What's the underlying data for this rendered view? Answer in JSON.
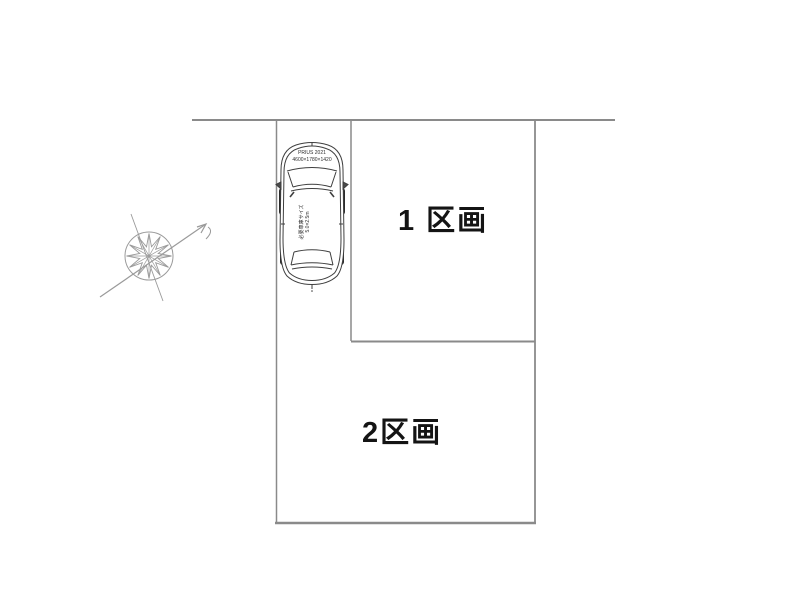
{
  "diagram": {
    "title": "parking-plot-layout",
    "plots": {
      "plot1": {
        "label": "1 区画"
      },
      "plot2": {
        "label": "2区画"
      }
    },
    "car": {
      "model": "PRIUS 2021",
      "size": "4600×1780×1420",
      "note_line1": "必要車庫サイズ",
      "note_line2": "5.0×2.5m"
    },
    "colors": {
      "boundary_line": "#8a8a8a",
      "car_line": "#3f3f3f",
      "label_text": "#141414",
      "compass_line": "#9a9a9a",
      "background": "#ffffff"
    }
  }
}
